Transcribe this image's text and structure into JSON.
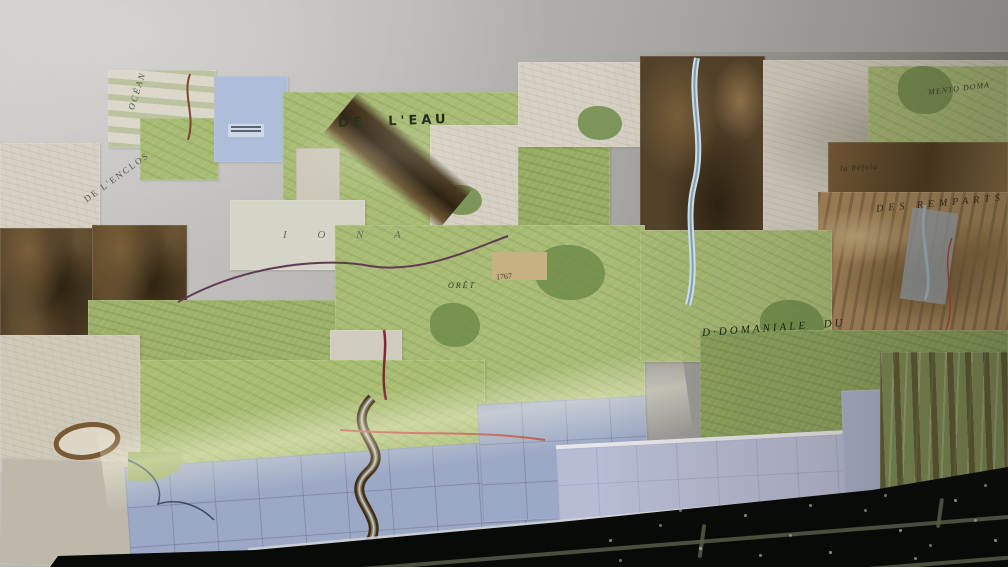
{
  "meta": {
    "description": "Photograph: collage of topographic map sheets taped to a wall above a dark tiled floor"
  },
  "labels": {
    "ocean": "OCÉAN",
    "de_leau": "DE  L'EAU",
    "de_lenclos": "DE L'ENCLOS",
    "iona": "I O N A",
    "foret": "ORÊT",
    "spot_height_1767": "1767",
    "domaniale_du": "D·DOMANIALE  DU",
    "mento_doma": "MENTO  DOMA",
    "des_remparts": "DES  REMPARTS",
    "la_refola": "la Réfola"
  },
  "colors": {
    "wall": "#b5b3b0",
    "map_green": "#a7bb74",
    "map_pale": "#d6d1c4",
    "sea_blue": "#9ba8c6",
    "lavender_sheet": "#b7bbd3",
    "gorge_brown": "#54422a",
    "floor": "#0d0f0b",
    "grout": "#565b47",
    "road_red": "#b8483a",
    "road_purple": "#5f3a55",
    "river_blue": "#a9c4d2"
  }
}
